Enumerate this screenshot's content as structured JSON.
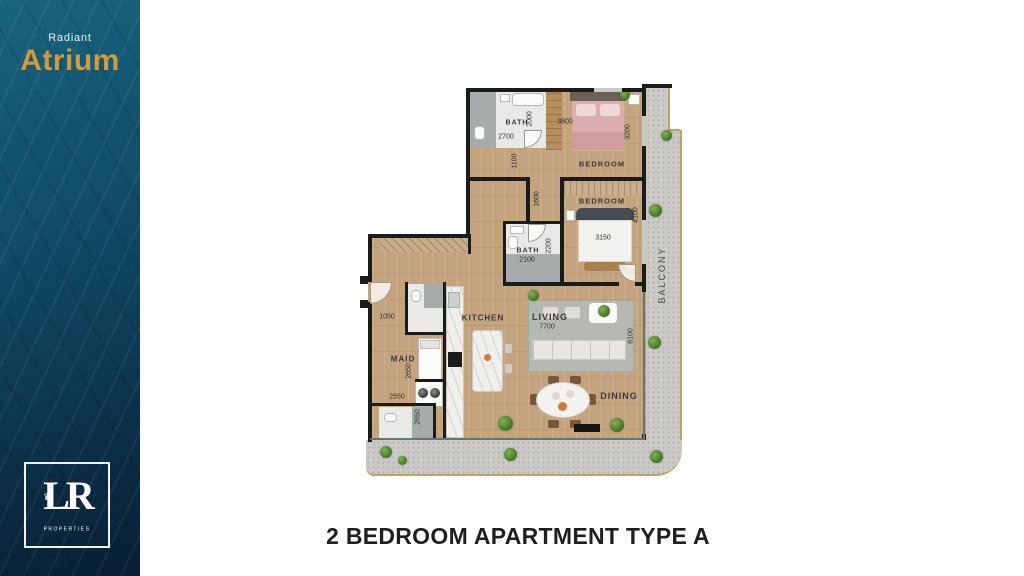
{
  "sidebar": {
    "brand_top": "Radiant",
    "brand_name": "Atrium",
    "logo": {
      "monogram": "LR",
      "crown": "♛",
      "caption": "PROPERTIES"
    }
  },
  "title": {
    "text": "2 BEDROOM APARTMENT TYPE A"
  },
  "plan": {
    "labels": {
      "bath1": "BATH",
      "bath2": "BATH",
      "bedroom1": "BEDROOM",
      "bedroom2": "BEDROOM",
      "maid": "MAID",
      "kitchen": "KITCHEN",
      "living": "LIVING",
      "dining": "DINING",
      "balcony": "BALCONY"
    },
    "dims": {
      "bath1_w": "2700",
      "bath1_h": "2000",
      "hall": "1100",
      "bed1_w": "3800",
      "bed1_side": "3200",
      "corridor": "1600",
      "bed2_side": "4100",
      "bed2_bed": "3150",
      "bath2_w": "2100",
      "bath2_h": "2200",
      "entry": "1050",
      "maid_d": "2650",
      "maid_w": "2550",
      "maid_bath": "2650",
      "living_w": "7700",
      "living_d": "6100"
    },
    "colors": {
      "sidebar_teal": "#135773",
      "sidebar_navy": "#0a1f33",
      "brand_gold": "#cf9b40",
      "wood": "#c4a37f",
      "wall": "#1b1b1b",
      "balcony": "#cac9c6",
      "bed_pink": "#d9aeae",
      "trim_gold": "#bda267"
    }
  }
}
